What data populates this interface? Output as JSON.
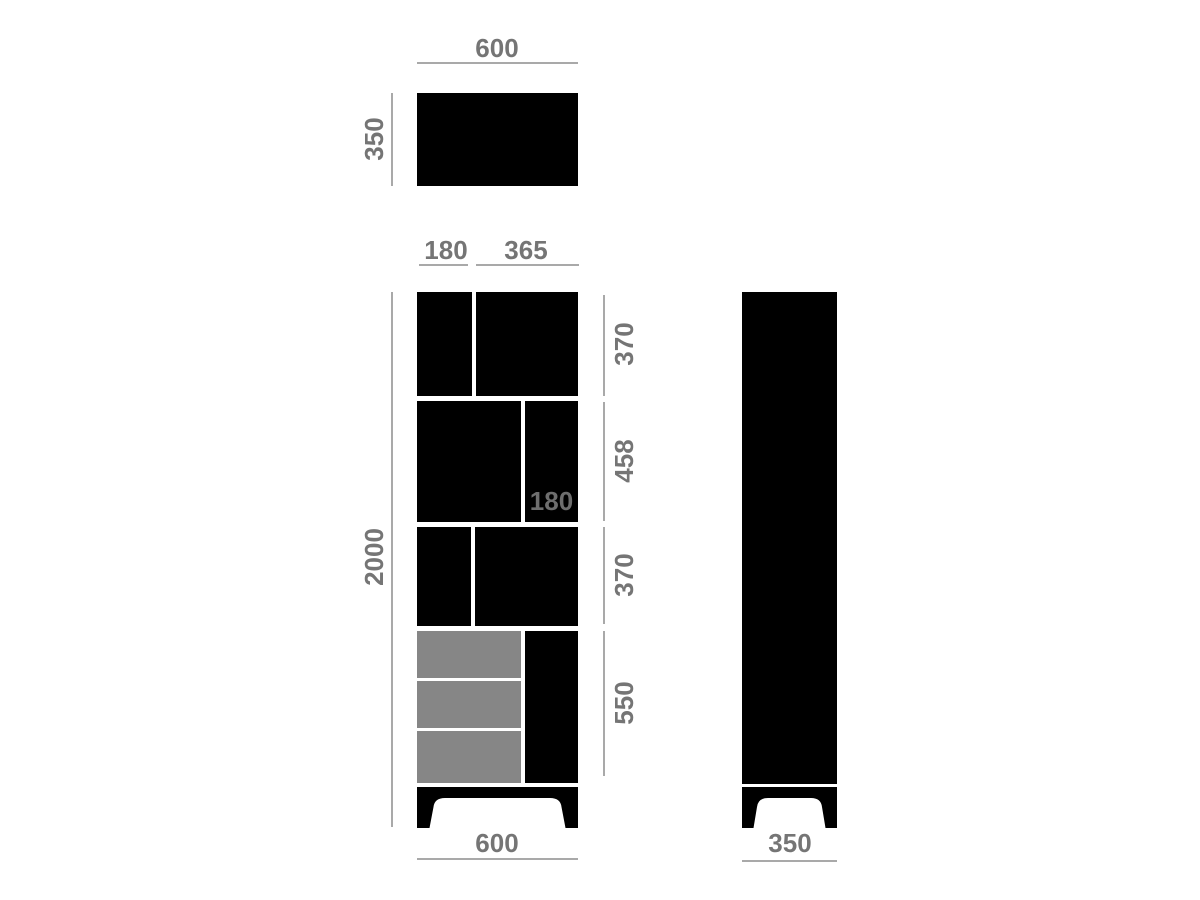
{
  "diagram": {
    "title": "furniture-dimension-drawing",
    "colors": {
      "bg": "#ffffff",
      "body": "#000000",
      "drawer": "#868686",
      "label": "#757575",
      "innerLabel": "#6e6e6e",
      "line": "#a9a9a9"
    },
    "top_view": {
      "width": "600",
      "depth": "350"
    },
    "front_view": {
      "shelf_left_width": "180",
      "shelf_right_width": "365",
      "total_height": "2000",
      "inner_width": "180",
      "row_heights": [
        "370",
        "458",
        "370",
        "550"
      ],
      "base_width": "600"
    },
    "side_view": {
      "depth": "350"
    }
  }
}
